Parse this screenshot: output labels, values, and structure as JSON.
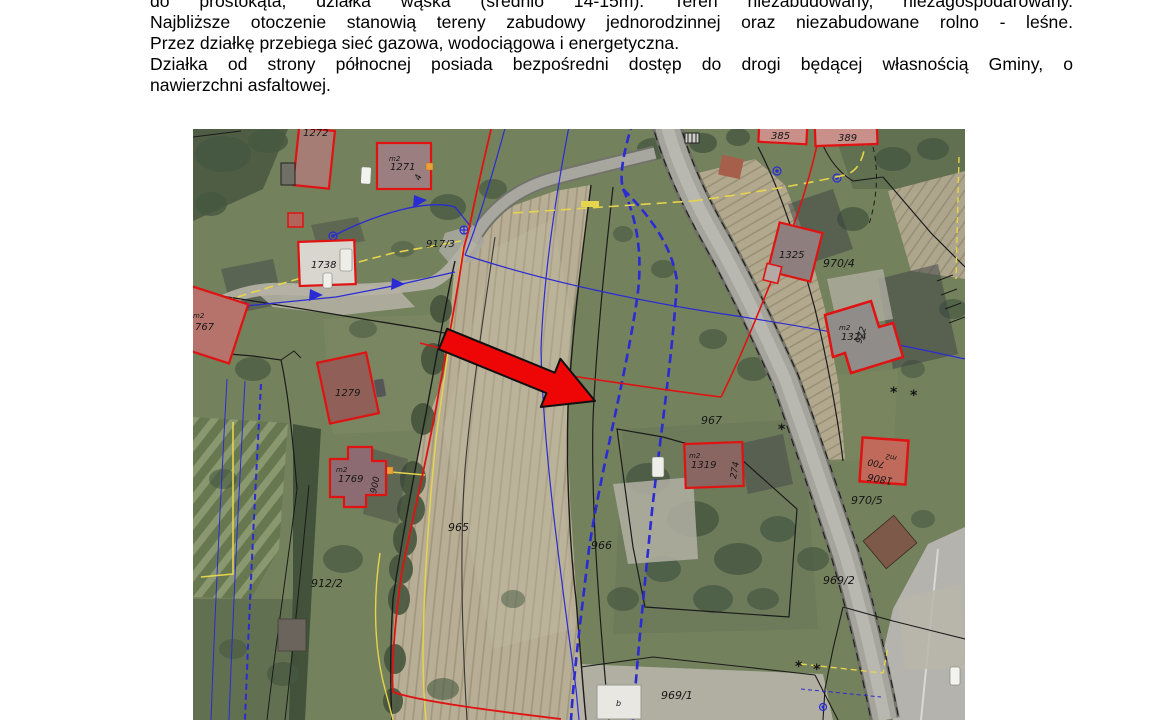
{
  "document": {
    "lines": [
      "do prostokąta, działka wąska (średnio 14-15m). Teren niezabudowany, niezagospodarowany.",
      "Najbliższe otoczenie stanowią tereny zabudowy jednorodzinnej oraz niezabudowane rolno - leśne.",
      "Przez działkę przebiega sieć gazowa, wodociągowa i energetyczna.",
      "Działka od strony północnej posiada bezpośredni dostęp do drogi będącej własnością Gminy, o",
      "nawierzchni asfaltowej."
    ]
  },
  "map": {
    "type": "aerial-cadastral-map",
    "colors": {
      "building_outline": "#e01212",
      "arrow": "#ee0505",
      "water_line": "#2b2bd4",
      "gas_line": "#e6d44c",
      "boundary": "#1b1b1b",
      "road": "#a6a59d",
      "field": "#b7ae95",
      "grass": "#74815d"
    }
  },
  "map_labels": {
    "parcels": {
      "p965": "965",
      "p966": "966",
      "p967": "967",
      "p912_2": "912/2",
      "p969_1": "969/1",
      "p969_2": "969/2",
      "p970_4": "970/4",
      "p970_5": "970/5",
      "p917_3": "917/3"
    },
    "buildings": {
      "b1272": "1272",
      "b1271": "1271",
      "b1738": "1738",
      "b767": "767",
      "b1279": "1279",
      "b1769": "1769",
      "b1319": "1319",
      "b1325": "1325",
      "b1324": "1324",
      "b1806": "1806",
      "b385": "385",
      "b389": "389"
    },
    "annotations": {
      "m2": "m2",
      "n4": "4",
      "n900": "900",
      "n274": "274",
      "n700": "700",
      "n972": "972",
      "garage_b": "b"
    }
  }
}
